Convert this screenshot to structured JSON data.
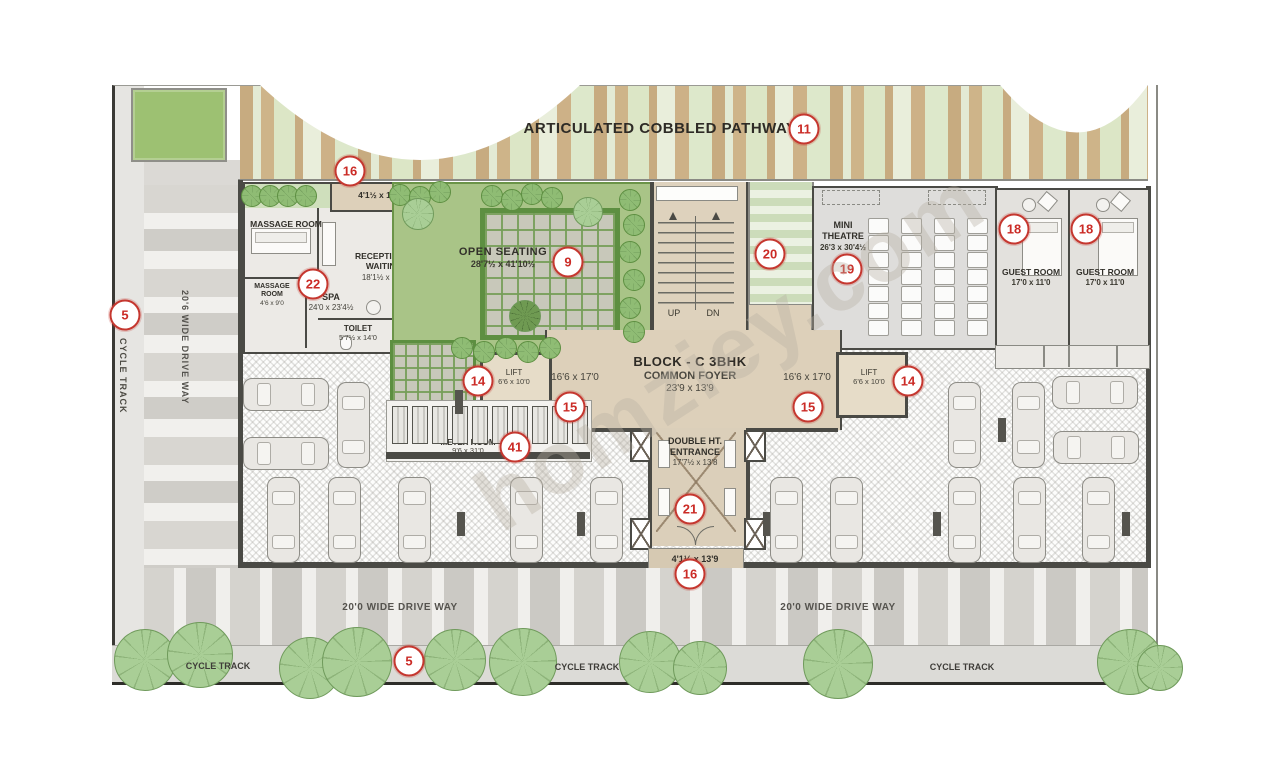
{
  "watermark": "homziey.com",
  "pathway": {
    "label": "ARTICULATED COBBLED PATHWAY",
    "badge": "11"
  },
  "left_road": {
    "cycle_track_label": "CYCLE TRACK",
    "cycle_track_badge": "5",
    "driveway_label": "20'6 WIDE DRIVE WAY"
  },
  "wellness": {
    "entry_strip": {
      "badge": "16",
      "dim": "4'1½ x 11'0"
    },
    "massage_room": {
      "label": "MASSAGE ROOM"
    },
    "massage_room_small": {
      "label1": "MASSAGE",
      "label2": "ROOM",
      "dim": "4'6 x 9'0"
    },
    "reception": {
      "label1": "RECEPTION &",
      "label2": "WAITING",
      "dim": "18'1½ x 11'0"
    },
    "spa": {
      "badge": "22",
      "label": "SPA",
      "dim": "24'0 x 23'4½"
    },
    "toilet": {
      "label": "TOILET",
      "dim": "5'7½ x 14'0"
    }
  },
  "garden": {
    "label": "OPEN SEATING",
    "dim": "28'7½ x 41'10½",
    "badge": "9"
  },
  "stairs": {
    "up": "UP",
    "dn": "DN"
  },
  "ramp": {
    "badge": "20"
  },
  "theatre": {
    "label1": "MINI",
    "label2": "THEATRE",
    "dim": "26'3 x 30'4½",
    "badge": "19"
  },
  "guest_rooms": [
    {
      "badge": "18",
      "label": "GUEST ROOM",
      "dim": "17'0 x 11'0"
    },
    {
      "badge": "18",
      "label": "GUEST ROOM",
      "dim": "17'0 x 11'0"
    }
  ],
  "core": {
    "block_title": "BLOCK - C 3BHK",
    "foyer_label": "COMMON FOYER",
    "foyer_dim": "23'9 x 13'9",
    "wing_left": {
      "dim": "16'6 x 17'0",
      "badge": "15"
    },
    "wing_right": {
      "dim": "16'6 x 17'0",
      "badge": "15"
    },
    "lift_left": {
      "label": "LIFT",
      "dim": "6'6 x 10'0",
      "badge": "14"
    },
    "lift_right": {
      "label": "LIFT",
      "dim": "6'6 x 10'0",
      "badge": "14"
    },
    "meter_room": {
      "label": "METER ROOM",
      "dim": "9'6 x 31'0",
      "badge": "41"
    },
    "entrance": {
      "label1": "DOUBLE HT.",
      "label2": "ENTRANCE",
      "dim": "17'7½ x 13'8",
      "badge": "21"
    },
    "entrance_strip": {
      "dim": "4'1½ x 13'9",
      "badge": "16"
    }
  },
  "bottom_roads": {
    "driveway_left_label": "20'0 WIDE DRIVE WAY",
    "driveway_right_label": "20'0 WIDE DRIVE WAY",
    "driveway_badge": "5",
    "cycle_track_labels": [
      "CYCLE TRACK",
      "CYCLE TRACK",
      "CYCLE TRACK"
    ]
  },
  "colors": {
    "badge_red": "#c5372f",
    "path_tan": "#c9ae83",
    "path_green": "#dfe9cf",
    "garden_green": "#a9c487",
    "foyer_tan": "#ddd0ba",
    "wall_dark": "#4a4a45"
  }
}
